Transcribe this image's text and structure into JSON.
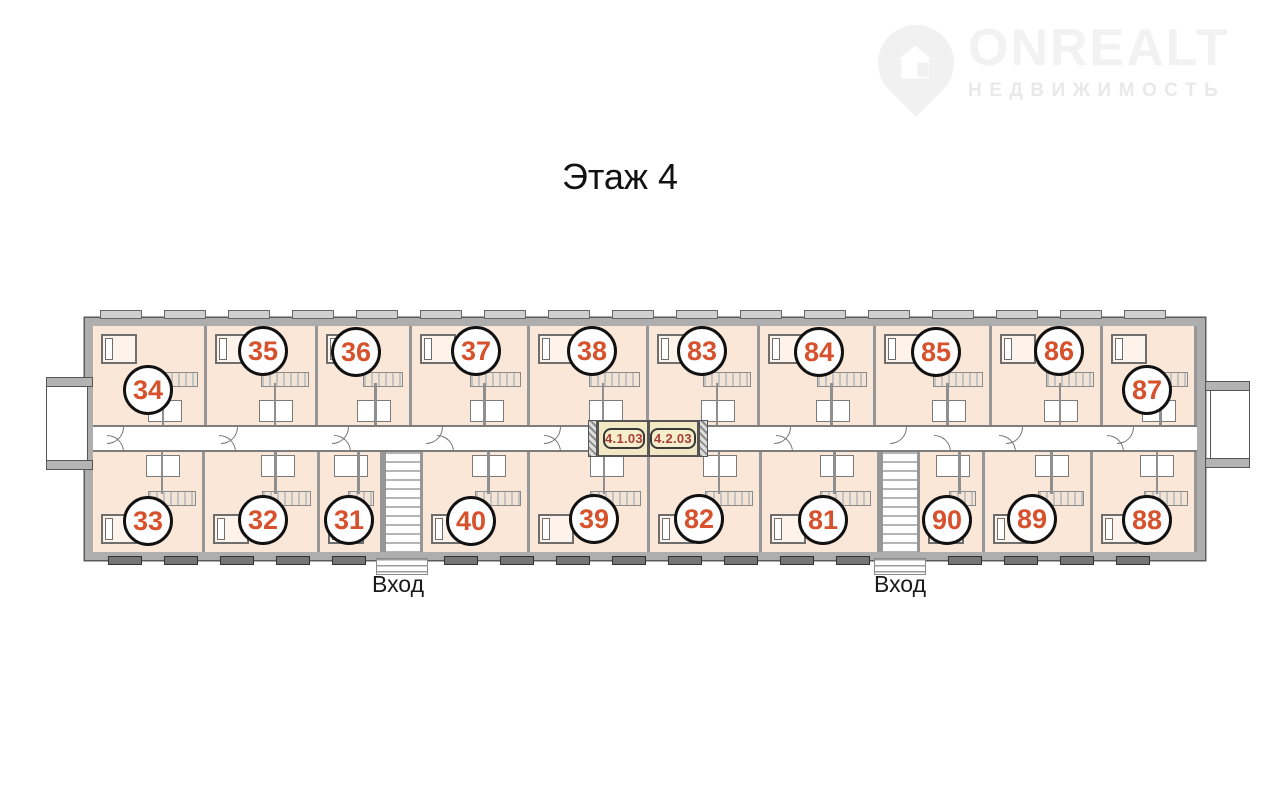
{
  "title": "Этаж 4",
  "logo": {
    "brand": "ONREALT",
    "subtitle": "НЕДВИЖИМОСТЬ"
  },
  "plan": {
    "entrances": [
      {
        "label": "Вход"
      },
      {
        "label": "Вход"
      }
    ],
    "elevators": [
      {
        "label": "4.1.03"
      },
      {
        "label": "4.2.03"
      }
    ],
    "units": [
      {
        "number": "34",
        "band": "top",
        "left": 93,
        "width": 114,
        "cx": 148,
        "cy": 390
      },
      {
        "number": "35",
        "band": "top",
        "left": 207,
        "width": 111,
        "cx": 263,
        "cy": 351
      },
      {
        "number": "36",
        "band": "top",
        "left": 318,
        "width": 94,
        "cx": 356,
        "cy": 352
      },
      {
        "number": "37",
        "band": "top",
        "left": 412,
        "width": 118,
        "cx": 476,
        "cy": 351
      },
      {
        "number": "38",
        "band": "top",
        "left": 530,
        "width": 119,
        "cx": 592,
        "cy": 351
      },
      {
        "number": "83",
        "band": "top",
        "left": 649,
        "width": 111,
        "cx": 702,
        "cy": 351
      },
      {
        "number": "84",
        "band": "top",
        "left": 760,
        "width": 116,
        "cx": 819,
        "cy": 352
      },
      {
        "number": "85",
        "band": "top",
        "left": 876,
        "width": 116,
        "cx": 936,
        "cy": 352
      },
      {
        "number": "86",
        "band": "top",
        "left": 992,
        "width": 111,
        "cx": 1059,
        "cy": 351
      },
      {
        "number": "87",
        "band": "top",
        "left": 1103,
        "width": 94,
        "cx": 1147,
        "cy": 390
      },
      {
        "number": "33",
        "band": "bottom",
        "left": 93,
        "width": 112,
        "cx": 148,
        "cy": 521
      },
      {
        "number": "32",
        "band": "bottom",
        "left": 205,
        "width": 115,
        "cx": 263,
        "cy": 520
      },
      {
        "number": "31",
        "band": "bottom",
        "left": 320,
        "width": 63,
        "cx": 349,
        "cy": 520
      },
      {
        "number": "40",
        "band": "bottom",
        "left": 423,
        "width": 107,
        "cx": 471,
        "cy": 521
      },
      {
        "number": "39",
        "band": "bottom",
        "left": 530,
        "width": 120,
        "cx": 594,
        "cy": 519
      },
      {
        "number": "82",
        "band": "bottom",
        "left": 650,
        "width": 112,
        "cx": 699,
        "cy": 519
      },
      {
        "number": "81",
        "band": "bottom",
        "left": 762,
        "width": 118,
        "cx": 823,
        "cy": 520
      },
      {
        "number": "90",
        "band": "bottom",
        "left": 920,
        "width": 65,
        "cx": 947,
        "cy": 520
      },
      {
        "number": "89",
        "band": "bottom",
        "left": 985,
        "width": 108,
        "cx": 1032,
        "cy": 519
      },
      {
        "number": "88",
        "band": "bottom",
        "left": 1093,
        "width": 104,
        "cx": 1147,
        "cy": 520
      }
    ]
  },
  "colors": {
    "apartment_fill": "#fae7d8",
    "wall_gray": "#aeaeae",
    "unit_number": "#d6512c",
    "elevator_label_text": "#a63e36",
    "elevator_fill": "#f2e9c4",
    "watermark_gray": "#f1f1f1"
  }
}
